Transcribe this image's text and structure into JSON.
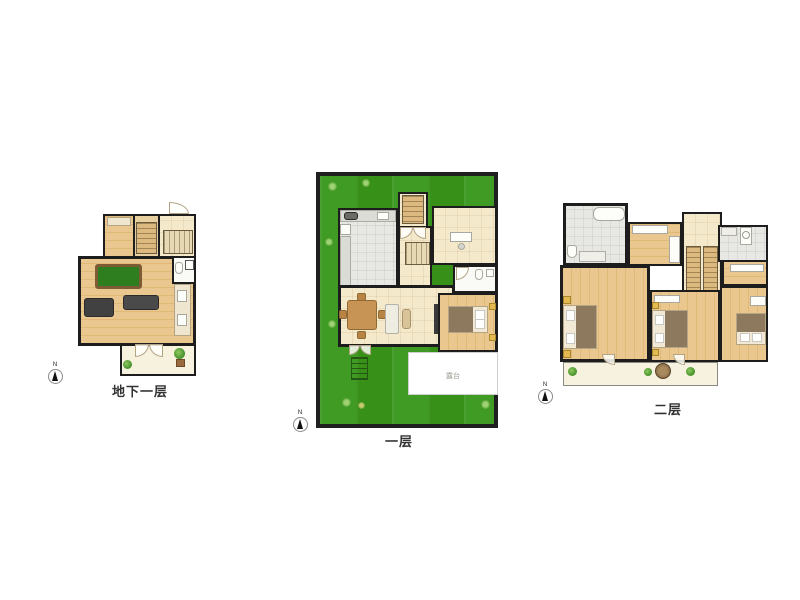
{
  "page": {
    "background": "#ffffff"
  },
  "floors": [
    {
      "id": "basement",
      "label": "地下一层"
    },
    {
      "id": "first-floor",
      "label": "一层"
    },
    {
      "id": "second-floor",
      "label": "二层"
    }
  ],
  "annotations": {
    "terrace_label": "露台",
    "compass_letter": "N"
  },
  "colors": {
    "wall": "#1d1d1d",
    "wood_floor": "#e7c187",
    "pale_floor": "#f5e9cb",
    "tile_floor": "#e7e7e4",
    "lawn_green": "#3a9220",
    "billiard_green": "#2e7d1f",
    "terrace_white": "#ffffff",
    "balcony_cream": "#f7f2df",
    "label_text": "#333333"
  }
}
